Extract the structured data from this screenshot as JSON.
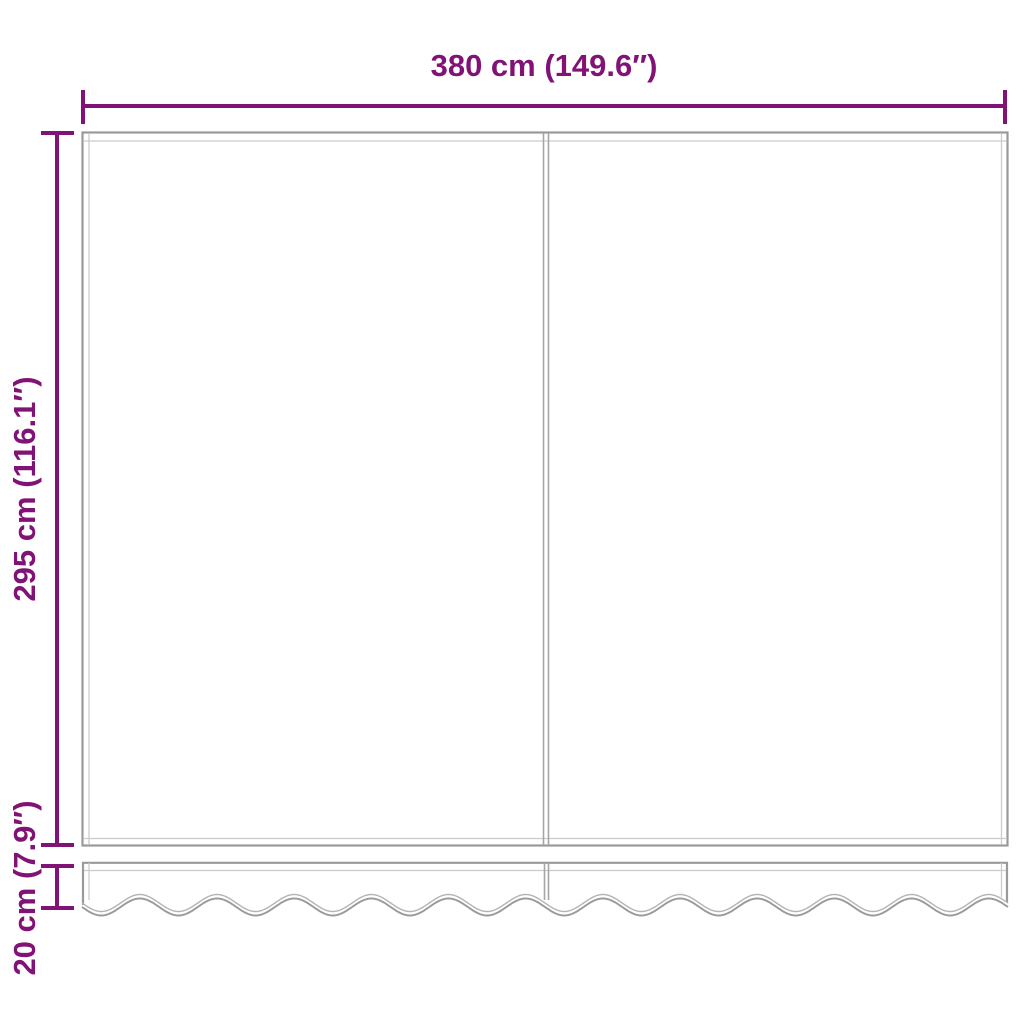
{
  "diagram": {
    "type": "product-dimension-drawing",
    "subject": "awning-replacement-fabric-with-valance",
    "labels": {
      "width": "380 cm (149.6″)",
      "height": "295 cm (116.1″)",
      "valance_height": "20 cm (7.9″)"
    },
    "colors": {
      "dimension": "#821376",
      "panel_outline": "#9a9a9a",
      "panel_inner_line": "#cbcbcb",
      "seam": "#a6a6a6",
      "background": "#ffffff"
    }
  }
}
